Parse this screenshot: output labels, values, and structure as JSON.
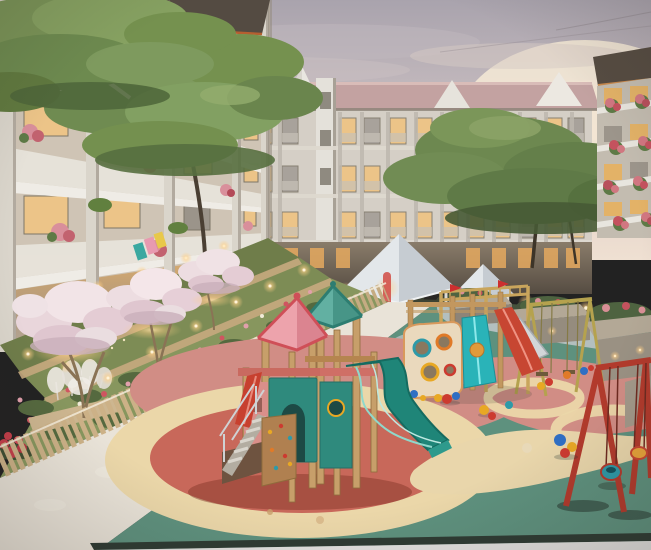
{
  "scene": {
    "subject": "dusk courtyard of a modern apartment complex with a colorful children's playground",
    "palette": {
      "sky_top": "#a9a3ad",
      "sky_mid": "#c9bec1",
      "sky_horizon": "#ecdccd",
      "sun_glow": "#f6ead6",
      "roof_back": "#c3a2a1",
      "gable": "#e9e6e0",
      "facade_back": "#d5cfc6",
      "stair_tower": "#e4e1da",
      "window_warm": "#ecc488",
      "window_cool": "#a8a29b",
      "left_facade": "#cfc4b5",
      "pier": "#dad5cb",
      "balcony": "#eceae2",
      "roof_dark": "#5c5349",
      "roof_fascia": "#c06a36",
      "tree_green": "#75914f",
      "tree_green_dark": "#566f3f",
      "tree_green_light": "#93ad6e",
      "blossom": "#f2e4e7",
      "blossom_shade": "#c9afba",
      "trunk": "#8a7355",
      "garden_green": "#7d8c55",
      "flower_pink": "#d98f9b",
      "flower_red": "#c4525e",
      "planter_wood": "#cdb690",
      "fence_wood": "#ccb187",
      "path": "#e9e3d8",
      "hedge": "#45523c",
      "pavement": "#8d8173",
      "light_warm": "#ffdf9e",
      "gazebo_roof": "#e3e7ea",
      "gazebo_shade": "#c6ccd2",
      "surface_teal": "#5e917e",
      "surface_cream": "#ebd7a9",
      "surface_coral": "#c8685a",
      "surface_rose": "#d18d85",
      "surface_blue": "#b7c2c3",
      "wood_post": "#c79f6a",
      "wood_dark": "#9a7442",
      "roof_pink": "#eda3ac",
      "roof_pink_trim": "#cf4f58",
      "roof_teal": "#62b0a2",
      "roof_teal_trim": "#2d7d71",
      "panel_teal": "#2f8a7d",
      "panel_arch": "#1d4a45",
      "slide_teal": "#1f8578",
      "slide_cyan": "#2ab3b8",
      "slide_red": "#c74632",
      "stairs_metal": "#cfd2d4",
      "climb_wall": "#b08050",
      "swing_red": "#b23a2c",
      "swing_yellow": "#b5a24e",
      "seat_teal": "#2e9aa8",
      "toy_red": "#cc3b30",
      "toy_yellow": "#e8a824",
      "toy_blue": "#2f6fc4",
      "toy_orange": "#e07a28",
      "edge_dark": "#2e3b33",
      "bottom_strip": "#e2e1df"
    },
    "objects": {
      "buildings": [
        "left-apartment-block",
        "central-apartment-block",
        "right-apartment-block"
      ],
      "vegetation": [
        "green-canopy-trees",
        "pink-blossom-trees",
        "terraced-flower-gardens",
        "hedge-row",
        "planter-boxes",
        "pampas-grass"
      ],
      "playground": [
        "main-play-tower",
        "pink-pyramid-roof",
        "teal-pyramid-roof",
        "teal-wave-slide",
        "cyan-slide",
        "red-slide",
        "climbing-panel",
        "climbing-wall",
        "monkey-bar-frame",
        "yellow-swing-frame",
        "red-swing-set",
        "swing-seats",
        "scattered-toys"
      ],
      "site": [
        "white-gazebo",
        "small-pavilion",
        "walking-path",
        "wooden-fence",
        "garden-lights",
        "rubber-safety-surface"
      ]
    }
  }
}
